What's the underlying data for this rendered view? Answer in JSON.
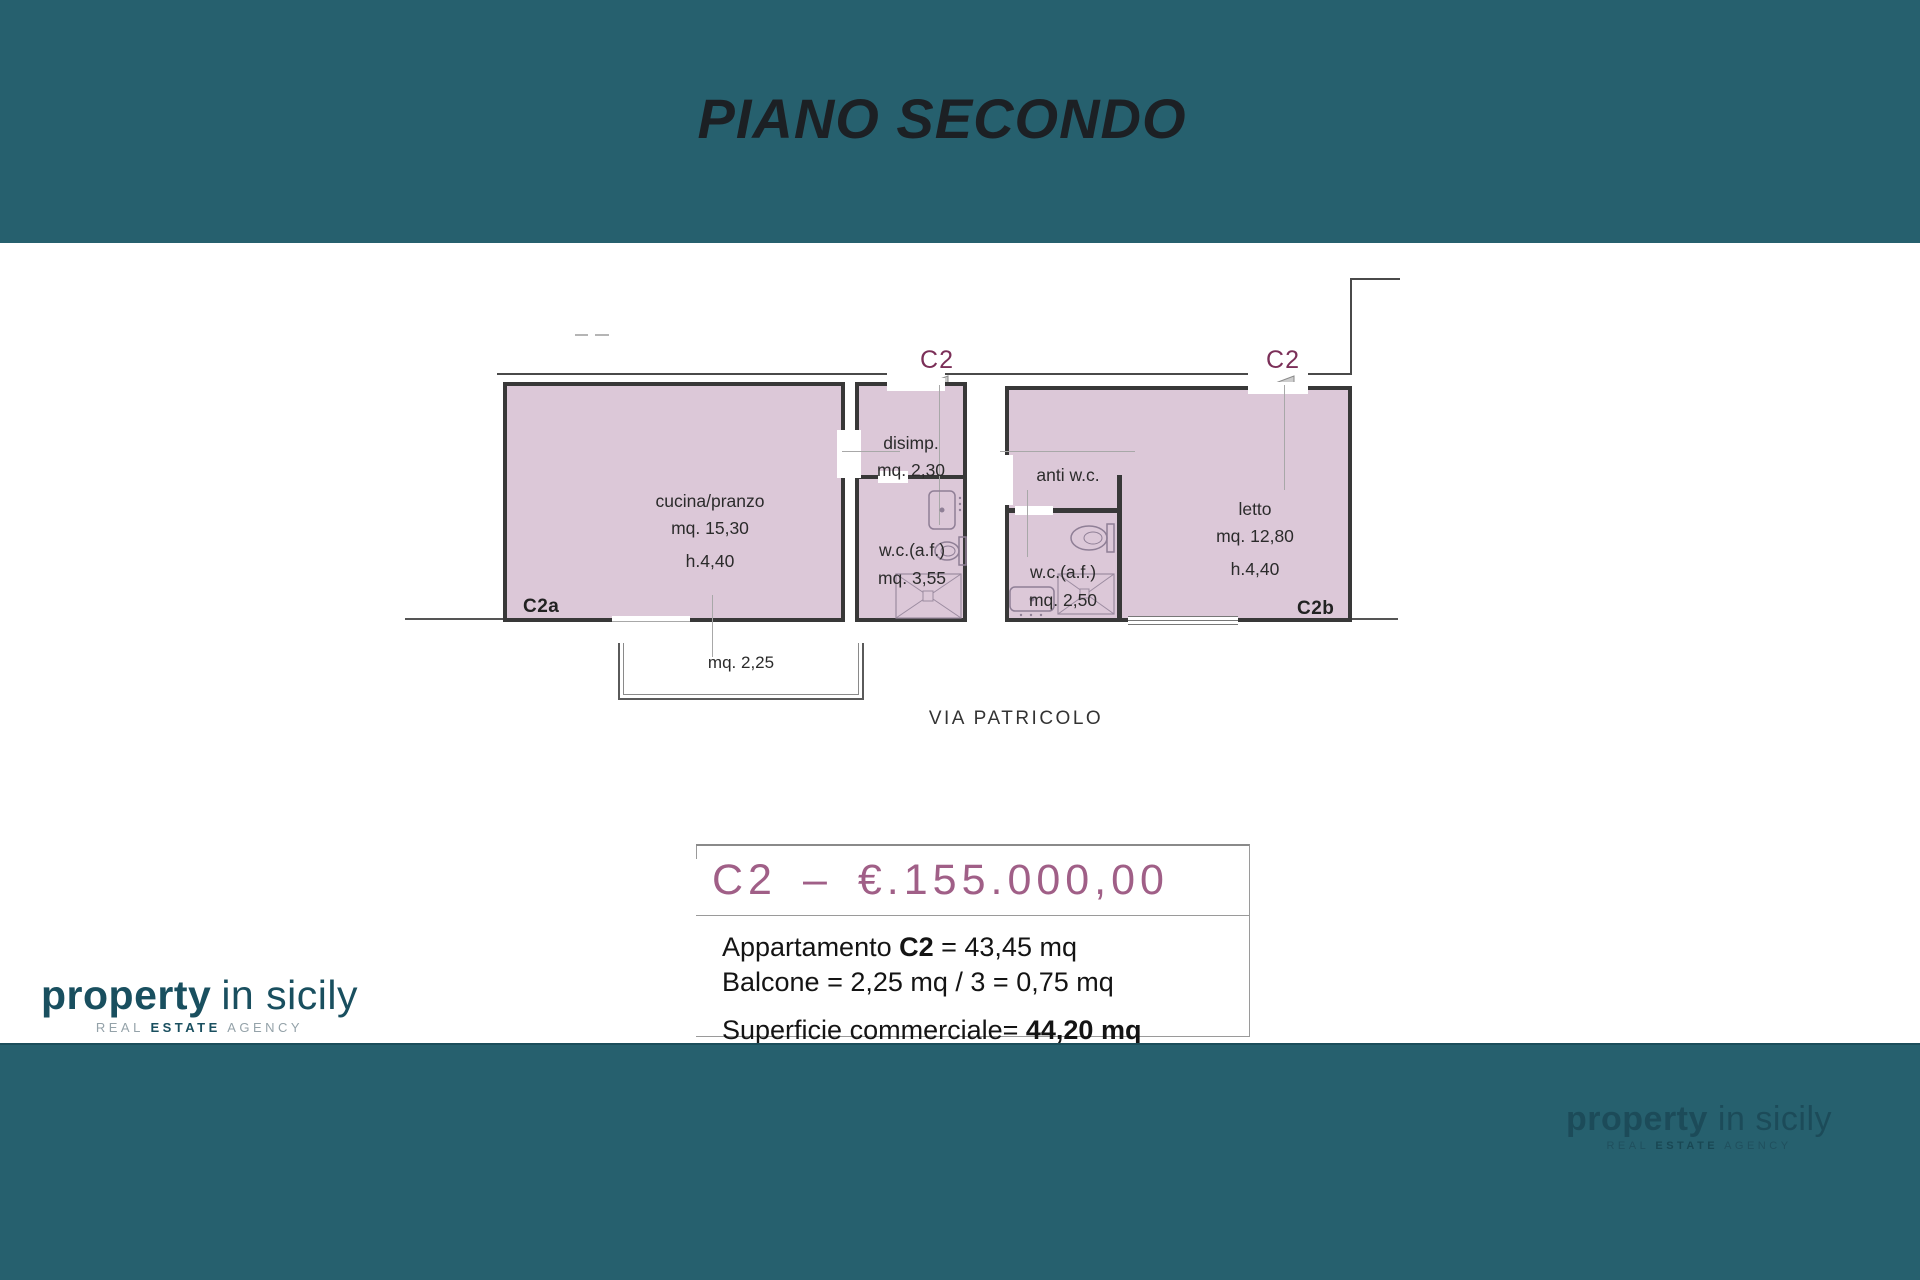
{
  "header": {
    "title": "PIANO SECONDO"
  },
  "plan": {
    "marker1": "C2",
    "marker2": "C2",
    "rooms": {
      "cucina": {
        "name": "cucina/pranzo",
        "area": "mq. 15,30",
        "height": "h.4,40"
      },
      "disimp": {
        "name": "disimp.",
        "area": "mq. 2,30"
      },
      "wc1": {
        "name": "w.c.(a.f.)",
        "area": "mq. 3,55"
      },
      "antiwc": {
        "name": "anti w.c."
      },
      "wc2": {
        "name": "w.c.(a.f.)",
        "area": "mq. 2,50"
      },
      "letto": {
        "name": "letto",
        "area": "mq. 12,80",
        "height": "h.4,40"
      }
    },
    "unit_a": "C2a",
    "unit_b": "C2b",
    "balcony_area": "mq. 2,25",
    "street": "VIA PATRICOLO"
  },
  "pricing": {
    "unit": "C2",
    "separator": "–",
    "price": "€.155.000,00",
    "line1_prefix": "Appartamento ",
    "line1_bold": "C2",
    "line1_suffix": " = 43,45 mq",
    "line2": "Balcone = 2,25 mq / 3 = 0,75 mq",
    "line3_prefix": "Superficie commerciale= ",
    "line3_bold": "44,20 mq"
  },
  "branding": {
    "wordmark_bold": "property",
    "wordmark_light": "in sicily",
    "tagline_pre": "REAL ",
    "tagline_bold": "ESTATE",
    "tagline_post": " AGENCY"
  }
}
